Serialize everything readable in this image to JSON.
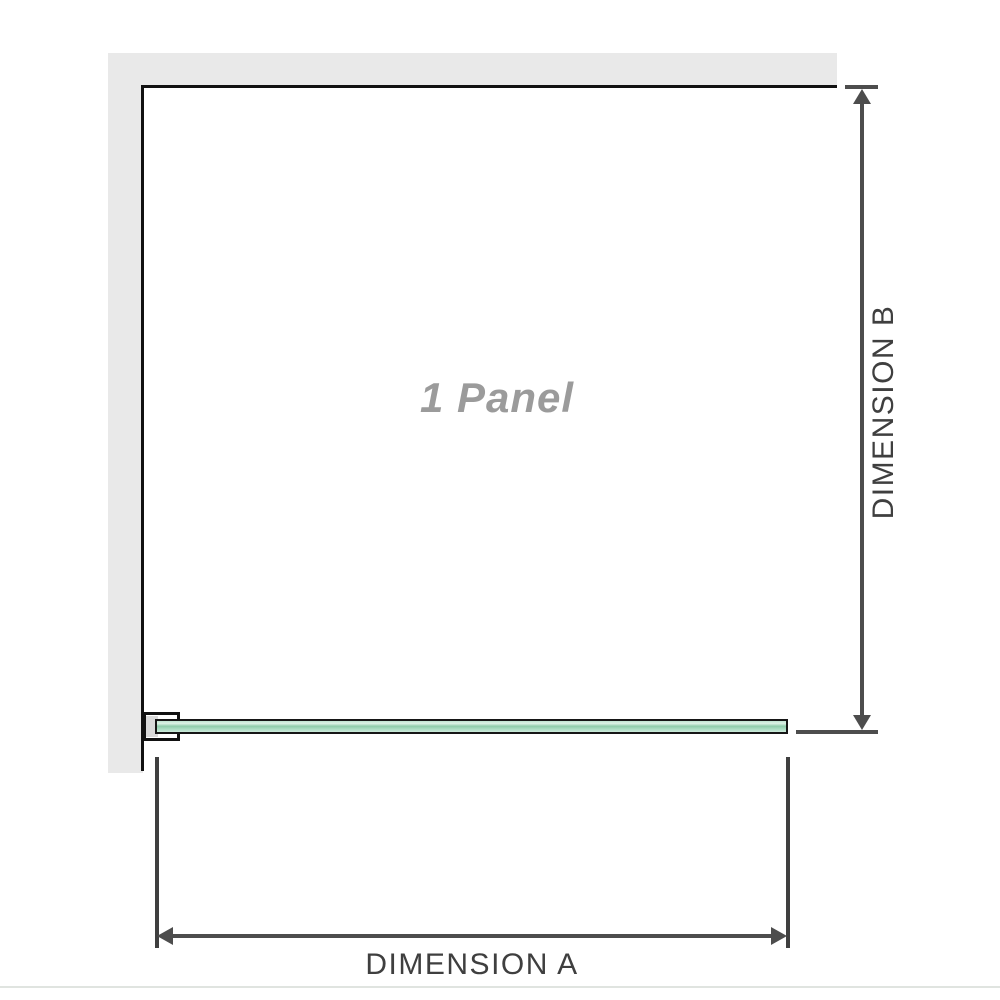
{
  "diagram": {
    "panel_label": "1 Panel",
    "dimensions": {
      "horizontal": {
        "label": "DIMENSION A"
      },
      "vertical": {
        "label": "DIMENSION B"
      }
    },
    "colors": {
      "wall_fill": "#e9e9e9",
      "frame_outline": "#111111",
      "dimension_line": "#4d4d4d",
      "dimension_label_text": "#3f3f3f",
      "glass_green_light": "#ddf2e6",
      "glass_green_dark": "#8fccab",
      "panel_label_text": "#9b9b9b",
      "bracket_fill": "#ffffff",
      "bracket_shade": "#d9d9d9",
      "bottom_rule": "#e0e4e0"
    }
  }
}
